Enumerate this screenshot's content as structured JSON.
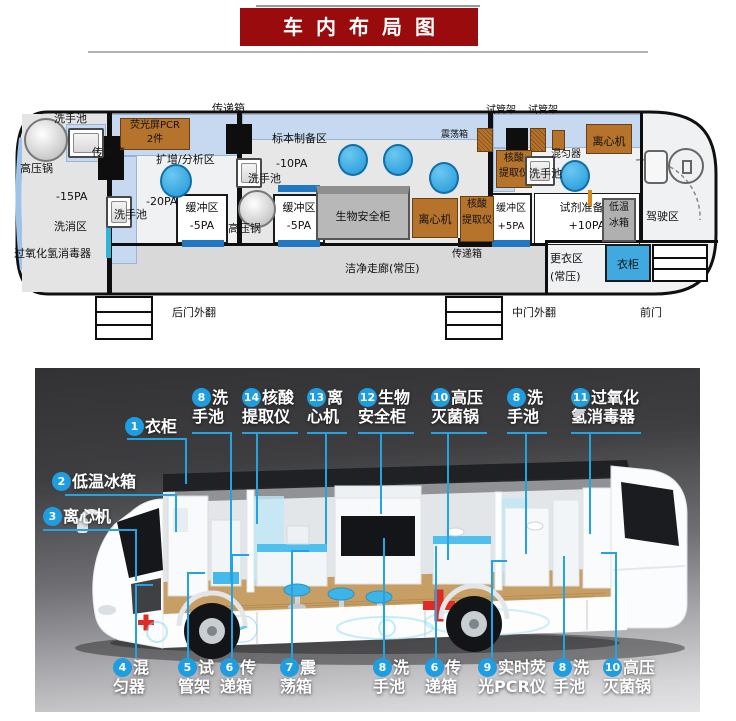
{
  "title": {
    "text": "车内布局图"
  },
  "floorplan": {
    "above": {
      "transfer_box": "传递箱",
      "tube_rack_a": "试管架",
      "tube_rack_b": "试管架"
    },
    "rear": {
      "autoclave": "高压锅",
      "sink": "洗手池",
      "pressure": "-15PA",
      "area": "洗消区",
      "h2o2": "过氧化氢消毒器"
    },
    "amp": {
      "transfer_box": "传递箱",
      "pcr1": "荧光屏PCR",
      "pcr2": "2件",
      "area": "扩增/分析区",
      "pressure": "-20PA",
      "sink": "洗手池",
      "buf": "缓冲区",
      "bufp": "-5PA"
    },
    "prep": {
      "area": "标本制备区",
      "pressure": "-10PA",
      "sink": "洗手池",
      "autoclave": "高压锅",
      "buf": "缓冲区",
      "bufp": "-5PA",
      "bsc": "生物安全柜",
      "centrifuge": "离心机",
      "ext1": "核酸",
      "ext2": "提取仪",
      "transfer_box": "传递箱",
      "shaker": "震荡箱"
    },
    "reagent": {
      "ext1": "核酸",
      "ext2": "提取仪",
      "mixer": "混匀器",
      "sink": "洗手池",
      "centrifuge": "离心机",
      "buf": "缓冲区",
      "bufp": "+5PA",
      "area1": "试剂准备区",
      "area2": "+10PA",
      "fre1": "低温",
      "fre2": "冰箱",
      "driver": "驾驶区",
      "chg1": "更衣区",
      "chg2": "(常压)",
      "wardrobe": "衣柜"
    },
    "corridor": "洁净走廊(常压)",
    "doors": {
      "rear": "后门外翻",
      "middle": "中门外翻",
      "front": "前门"
    }
  },
  "render": {
    "top": [
      {
        "num": "1",
        "label": "衣柜"
      },
      {
        "num": "8",
        "label": "洗手池"
      },
      {
        "num": "14",
        "label": "核酸提取仪"
      },
      {
        "num": "13",
        "label": "离心机"
      },
      {
        "num": "12",
        "label": "生物安全柜"
      },
      {
        "num": "10",
        "label": "高压灭菌锅"
      },
      {
        "num": "8",
        "label": "洗手池"
      },
      {
        "num": "11",
        "label": "过氧化氢消毒器"
      }
    ],
    "left": [
      {
        "num": "2",
        "label": "低温冰箱"
      },
      {
        "num": "3",
        "label": "离心机"
      }
    ],
    "bottom": [
      {
        "num": "4",
        "label": "混匀器"
      },
      {
        "num": "5",
        "label": "试管架"
      },
      {
        "num": "6",
        "label": "传递箱"
      },
      {
        "num": "7",
        "label": "震荡箱"
      },
      {
        "num": "8",
        "label": "洗手池"
      },
      {
        "num": "6",
        "label": "传递箱"
      },
      {
        "num": "9",
        "label": "实时荧光PCR仪"
      },
      {
        "num": "8",
        "label": "洗手池"
      },
      {
        "num": "10",
        "label": "高压灭菌锅"
      }
    ]
  },
  "colors": {
    "title_bg": "#9a0b0e",
    "callout_blue": "#1e9de0",
    "equipment_brown": "#b5732c",
    "counter_blue": "#c6d9f0",
    "door_blue": "#1f78c1",
    "stool_blue": "#2aa3e3",
    "cross_red": "#df2b23"
  }
}
